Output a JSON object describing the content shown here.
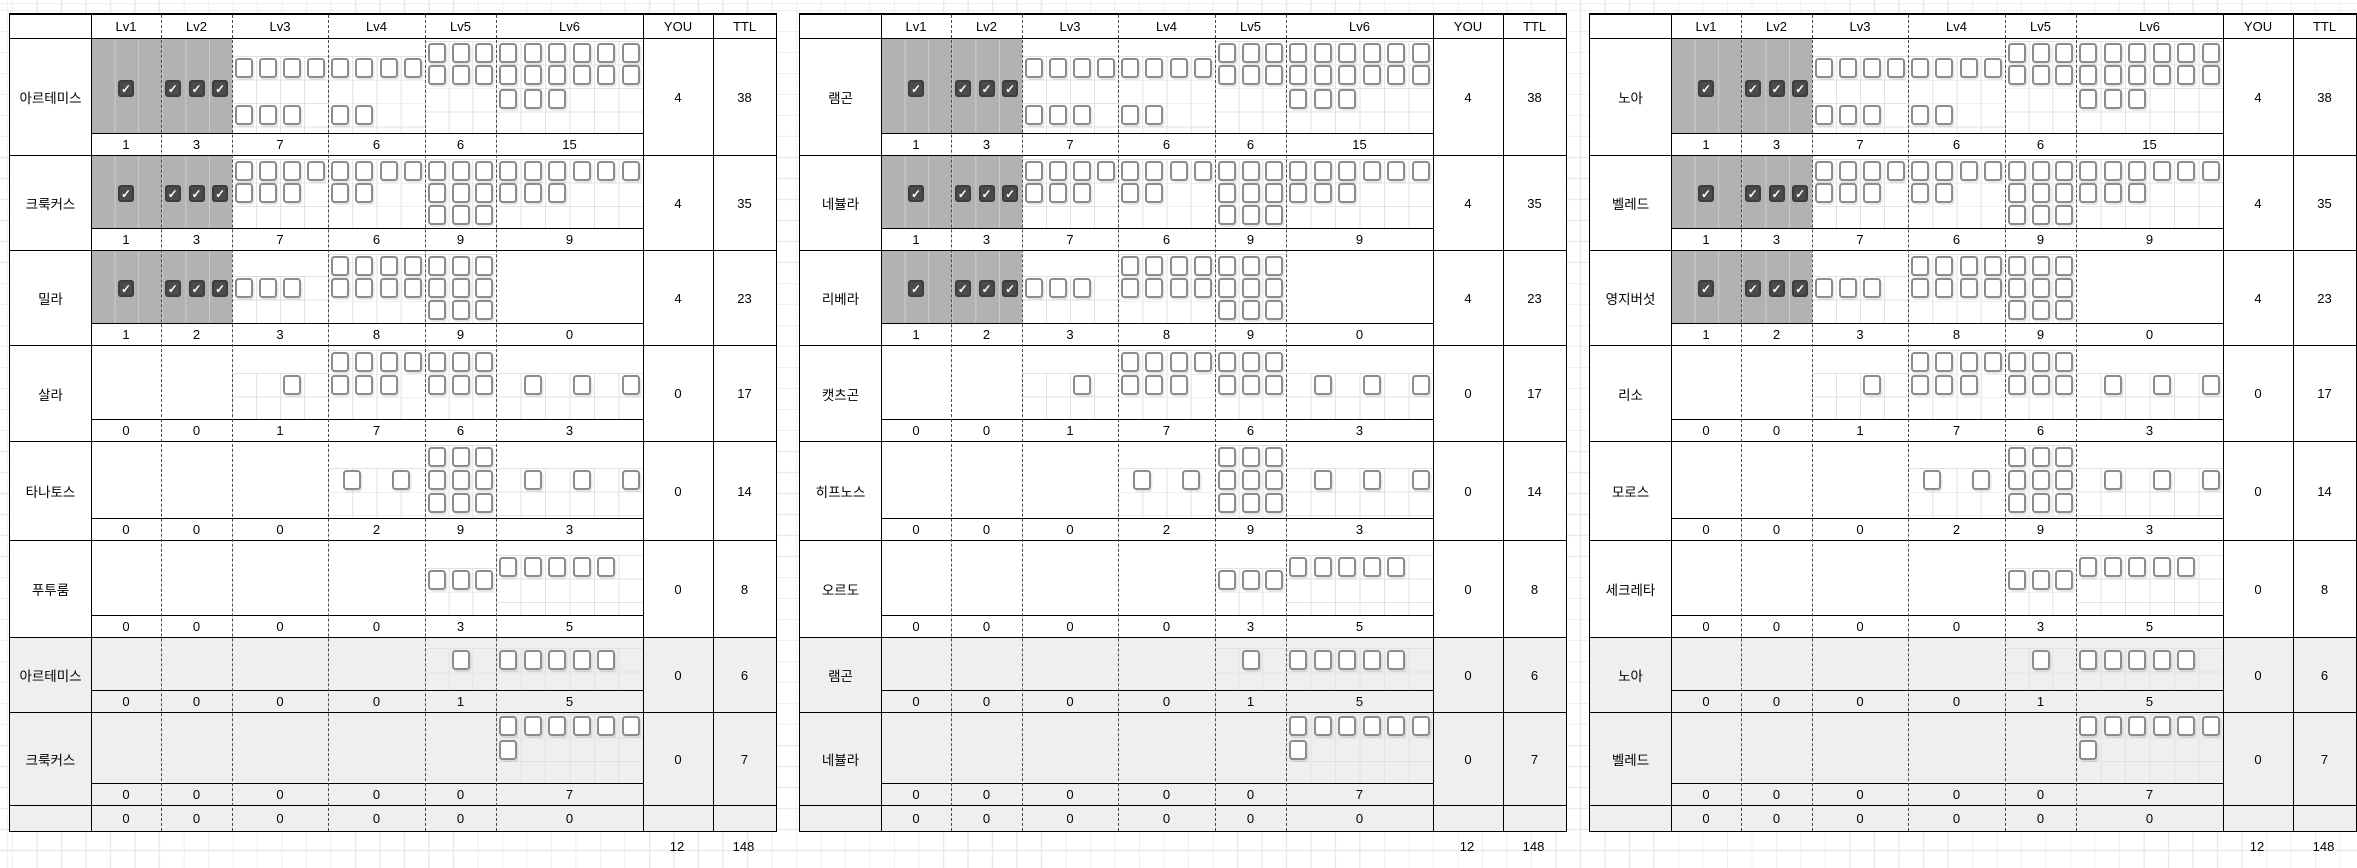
{
  "header": {
    "levels": [
      "Lv1",
      "Lv2",
      "Lv3",
      "Lv4",
      "Lv5",
      "Lv6"
    ],
    "you": "YOU",
    "ttl": "TTL"
  },
  "panels": [
    {
      "names": [
        "아르테미스",
        "크룩커스",
        "밀라",
        "살라",
        "타나토스",
        "푸투룸",
        "아르테미스",
        "크룩커스"
      ]
    },
    {
      "names": [
        "램곤",
        "네뷸라",
        "리베라",
        "캣츠곤",
        "히프노스",
        "오르도",
        "램곤",
        "네뷸라"
      ]
    },
    {
      "names": [
        "노아",
        "벨레드",
        "영지버섯",
        "리소",
        "모로스",
        "세크레타",
        "노아",
        "벨레드"
      ]
    }
  ],
  "blocks": [
    {
      "you": "4",
      "ttl": "38",
      "counts": [
        "1",
        "3",
        "7",
        "6",
        "6",
        "15"
      ],
      "dark": true,
      "gray": false,
      "bh": 94,
      "boxes": [
        {
          "lv": 1,
          "y": 40,
          "c": 0,
          "n": 1,
          "ck": true
        },
        {
          "lv": 2,
          "y": 40,
          "c": 0,
          "n": 3,
          "ck": true
        },
        {
          "lv": 3,
          "y": 19,
          "c": 0,
          "n": 4
        },
        {
          "lv": 3,
          "y": 66,
          "c": 0,
          "n": 3
        },
        {
          "lv": 4,
          "y": 19,
          "c": 0,
          "n": 4
        },
        {
          "lv": 4,
          "y": 66,
          "c": 0,
          "n": 2
        },
        {
          "lv": 5,
          "y": 4,
          "c": 0,
          "n": 3
        },
        {
          "lv": 5,
          "y": 26,
          "c": 0,
          "n": 3
        },
        {
          "lv": 6,
          "y": 4,
          "c": 0,
          "n": 6
        },
        {
          "lv": 6,
          "y": 26,
          "c": 0,
          "n": 6
        },
        {
          "lv": 6,
          "y": 50,
          "c": 0,
          "n": 3
        }
      ]
    },
    {
      "you": "4",
      "ttl": "35",
      "counts": [
        "1",
        "3",
        "7",
        "6",
        "9",
        "9"
      ],
      "dark": true,
      "gray": false,
      "bh": 72,
      "boxes": [
        {
          "lv": 1,
          "y": 28,
          "c": 0,
          "n": 1,
          "ck": true
        },
        {
          "lv": 2,
          "y": 28,
          "c": 0,
          "n": 3,
          "ck": true
        },
        {
          "lv": 3,
          "y": 5,
          "c": 0,
          "n": 4
        },
        {
          "lv": 3,
          "y": 27,
          "c": 0,
          "n": 3
        },
        {
          "lv": 4,
          "y": 5,
          "c": 0,
          "n": 4
        },
        {
          "lv": 4,
          "y": 27,
          "c": 0,
          "n": 2
        },
        {
          "lv": 5,
          "y": 5,
          "c": 0,
          "n": 3
        },
        {
          "lv": 5,
          "y": 27,
          "c": 0,
          "n": 3
        },
        {
          "lv": 5,
          "y": 49,
          "c": 0,
          "n": 3
        },
        {
          "lv": 6,
          "y": 5,
          "c": 0,
          "n": 6
        },
        {
          "lv": 6,
          "y": 27,
          "c": 0,
          "n": 3
        }
      ]
    },
    {
      "you": "4",
      "ttl": "23",
      "counts": [
        "1",
        "2",
        "3",
        "8",
        "9",
        "0"
      ],
      "dark": true,
      "gray": false,
      "bh": 72,
      "boxes": [
        {
          "lv": 1,
          "y": 28,
          "c": 0,
          "n": 1,
          "ck": true
        },
        {
          "lv": 2,
          "y": 28,
          "c": 0,
          "n": 3,
          "ck": true
        },
        {
          "lv": 3,
          "y": 27,
          "c": 0,
          "n": 3
        },
        {
          "lv": 4,
          "y": 5,
          "c": 0,
          "n": 4
        },
        {
          "lv": 4,
          "y": 27,
          "c": 0,
          "n": 4
        },
        {
          "lv": 5,
          "y": 5,
          "c": 0,
          "n": 3
        },
        {
          "lv": 5,
          "y": 27,
          "c": 0,
          "n": 3
        },
        {
          "lv": 5,
          "y": 49,
          "c": 0,
          "n": 3
        }
      ]
    },
    {
      "you": "0",
      "ttl": "17",
      "counts": [
        "0",
        "0",
        "1",
        "7",
        "6",
        "3"
      ],
      "dark": false,
      "gray": false,
      "bh": 73,
      "boxes": [
        {
          "lv": 3,
          "y": 29,
          "c": 2,
          "n": 1
        },
        {
          "lv": 4,
          "y": 6,
          "c": 0,
          "n": 4
        },
        {
          "lv": 4,
          "y": 29,
          "c": 0,
          "n": 3
        },
        {
          "lv": 5,
          "y": 6,
          "c": 0,
          "n": 3
        },
        {
          "lv": 5,
          "y": 29,
          "c": 0,
          "n": 3
        },
        {
          "lv": 6,
          "y": 29,
          "c": 1,
          "n": 3,
          "step": 2
        }
      ]
    },
    {
      "you": "0",
      "ttl": "14",
      "counts": [
        "0",
        "0",
        "0",
        "2",
        "9",
        "3"
      ],
      "dark": false,
      "gray": false,
      "bh": 76,
      "boxes": [
        {
          "lv": 4,
          "y": 28,
          "c": 0.5,
          "n": 2,
          "step": 2
        },
        {
          "lv": 5,
          "y": 5,
          "c": 0,
          "n": 3
        },
        {
          "lv": 5,
          "y": 28,
          "c": 0,
          "n": 3
        },
        {
          "lv": 5,
          "y": 51,
          "c": 0,
          "n": 3
        },
        {
          "lv": 6,
          "y": 28,
          "c": 1,
          "n": 3,
          "step": 2
        }
      ]
    },
    {
      "you": "0",
      "ttl": "8",
      "counts": [
        "0",
        "0",
        "0",
        "0",
        "3",
        "5"
      ],
      "dark": false,
      "gray": false,
      "bh": 74,
      "boxes": [
        {
          "lv": 5,
          "y": 29,
          "c": 0,
          "n": 3
        },
        {
          "lv": 6,
          "y": 16,
          "c": 0,
          "n": 5
        }
      ]
    },
    {
      "you": "0",
      "ttl": "6",
      "counts": [
        "0",
        "0",
        "0",
        "0",
        "1",
        "5"
      ],
      "dark": false,
      "gray": true,
      "bh": 52,
      "boxes": [
        {
          "lv": 5,
          "y": 12,
          "c": 1,
          "n": 1
        },
        {
          "lv": 6,
          "y": 12,
          "c": 0,
          "n": 5
        }
      ]
    },
    {
      "you": "0",
      "ttl": "7",
      "counts": [
        "0",
        "0",
        "0",
        "0",
        "0",
        "7"
      ],
      "dark": false,
      "gray": true,
      "bh": 70,
      "boxes": [
        {
          "lv": 6,
          "y": 3,
          "c": 0,
          "n": 6
        },
        {
          "lv": 6,
          "y": 27,
          "c": 0,
          "n": 1
        }
      ]
    }
  ],
  "zero_row": [
    "0",
    "0",
    "0",
    "0",
    "0",
    "0"
  ],
  "totals": {
    "you": "12",
    "ttl": "148"
  },
  "colors": {
    "dark_cell": "#b2b2b2",
    "checked_box": "#4b4b4b",
    "box_border": "#8c8c8c",
    "gray_row": "#efefef",
    "grid_line": "#e9e9e9",
    "subgrid_line": "#e2e2e2",
    "border": "#000000",
    "check_glyph": "✓"
  }
}
